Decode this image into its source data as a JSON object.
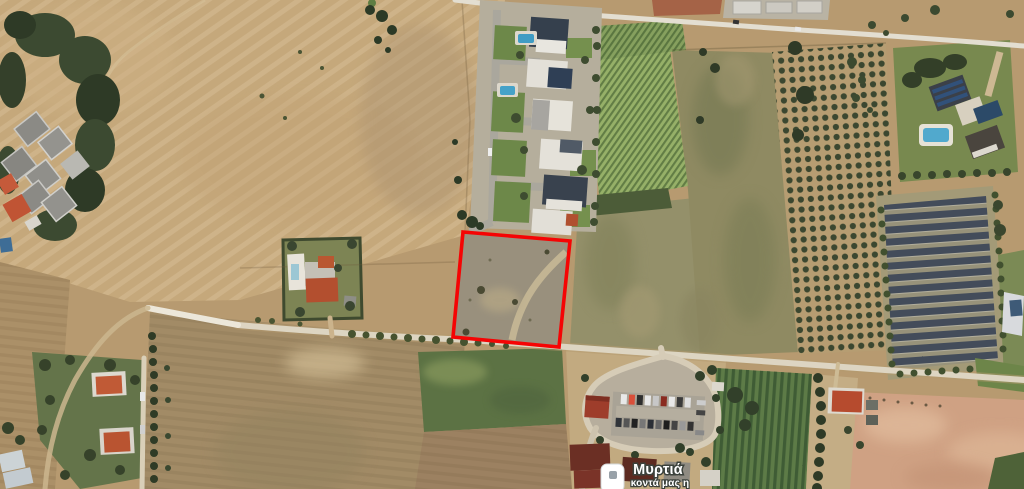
{
  "map": {
    "poi_label": {
      "title": "Μυρτιά",
      "subtitle": "κοντά μας η",
      "text_color": "#ffffff",
      "halo_color": "#3c423c"
    },
    "poi_marker": {
      "icon": "rounded-square-poi-marker",
      "fill": "#ffffff",
      "dot_color": "#98a1a8",
      "border_color": "#d4d8da"
    },
    "parcel_outline": {
      "color": "#f50404",
      "points": "463,232 570,241 559,347 453,337",
      "stroke_width": 3.6
    },
    "landmarks": {
      "pool_color": "#4aa3c9",
      "solar_panel_color": "#434c5a",
      "orange_roof_color": "#b64f30"
    }
  }
}
